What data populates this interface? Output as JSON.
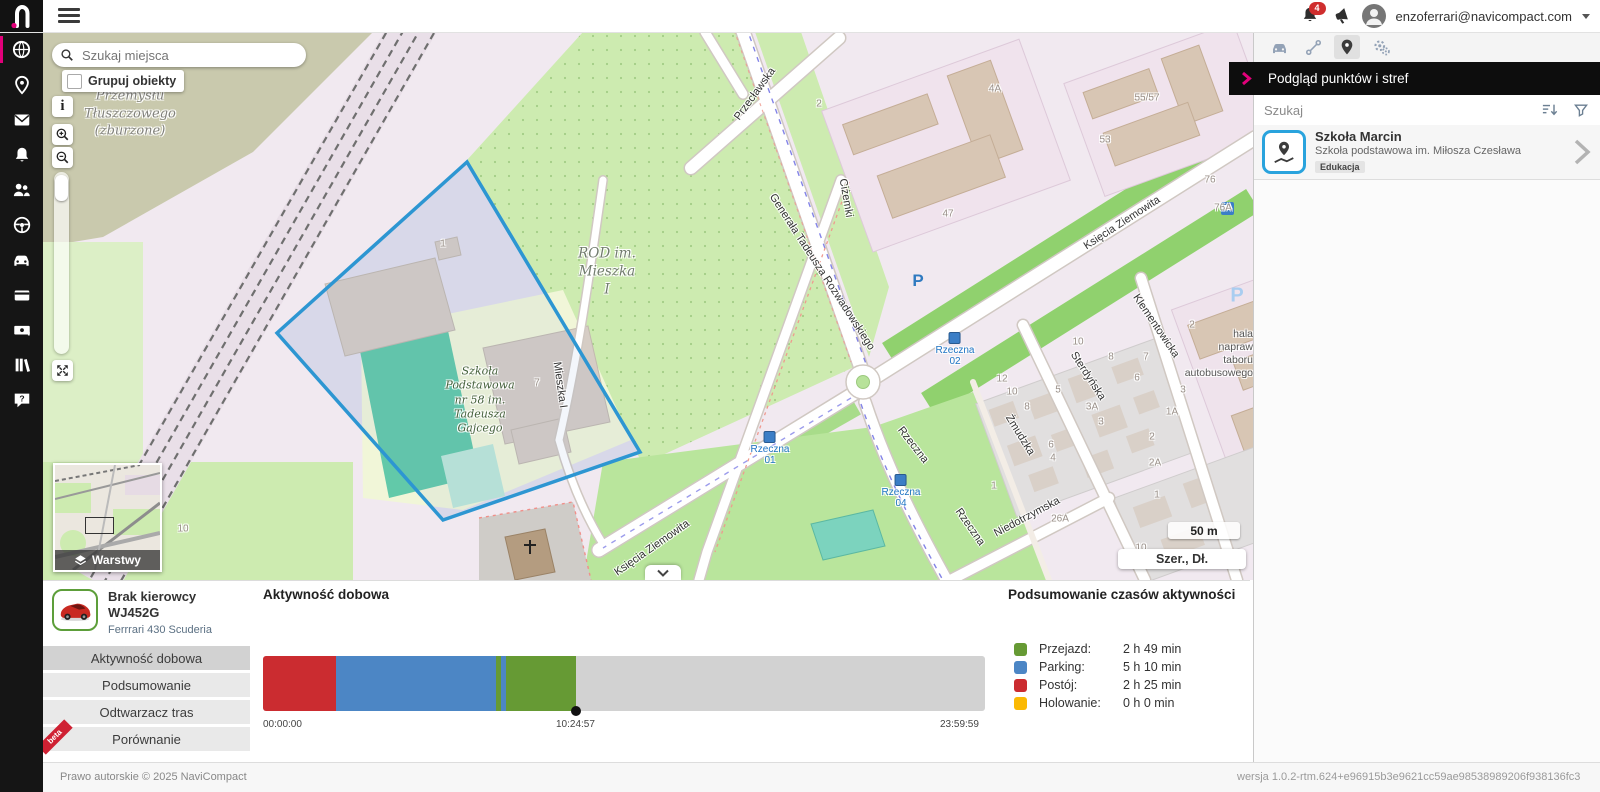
{
  "topbar": {
    "email": "enzoferrari@navicompact.com",
    "notification_count": "4"
  },
  "map": {
    "search_placeholder": "Szukaj miejsca",
    "group_label": "Grupuj obiekty",
    "info_label": "i",
    "layers_label": "Warstwy",
    "scale_label": "50 m",
    "coords_label": "Szer., Dł.",
    "parking_label": "P",
    "labels": {
      "industrial": "Przemysłu\nTłuszczowego\n(zburzone)",
      "rod": "ROD im.\nMieszka\nI",
      "school": "Szkoła\nPodstawowa\nnr 58 im.\nTadeusza\nGajcego",
      "hala": "hala\nnapraw\ntaboru\nautobusowego"
    },
    "streets": {
      "rozwadowskiego": "Generała Tadeusza Rozwadowskiego",
      "przeclawska": "Przecławska",
      "cizemki": "Ciżemki",
      "ksiecia_a": "Księcia Ziemowita",
      "ksiecia_b": "Księcia Ziemowita",
      "mieszka": "Mieszka I",
      "rzeczna_a": "Rzeczna",
      "rzeczna_b": "Rzeczna",
      "zmudzka": "Żmudzka",
      "sterdynska": "Sterdyńska",
      "klementowicka": "Klementowicka",
      "niedotrzymska": "Niedotrzymska"
    },
    "stops": {
      "s01": "Rzeczna\n01",
      "s02": "Rzeczna\n02",
      "s04": "Rzeczna\n04"
    },
    "numbers": [
      {
        "t": "1",
        "x": 400,
        "y": 212
      },
      {
        "t": "2",
        "x": 776,
        "y": 72
      },
      {
        "t": "47",
        "x": 905,
        "y": 182
      },
      {
        "t": "4A",
        "x": 952,
        "y": 57
      },
      {
        "t": "53",
        "x": 1062,
        "y": 108
      },
      {
        "t": "55/57",
        "x": 1104,
        "y": 66
      },
      {
        "t": "76",
        "x": 1167,
        "y": 148
      },
      {
        "t": "76A",
        "x": 1180,
        "y": 176
      },
      {
        "t": "7",
        "x": 494,
        "y": 351
      },
      {
        "t": "12",
        "x": 959,
        "y": 347
      },
      {
        "t": "10",
        "x": 969,
        "y": 360
      },
      {
        "t": "8",
        "x": 984,
        "y": 375
      },
      {
        "t": "5",
        "x": 1015,
        "y": 358
      },
      {
        "t": "3A",
        "x": 1049,
        "y": 375
      },
      {
        "t": "3",
        "x": 1058,
        "y": 390
      },
      {
        "t": "6",
        "x": 1008,
        "y": 413
      },
      {
        "t": "4",
        "x": 1010,
        "y": 426
      },
      {
        "t": "8",
        "x": 1068,
        "y": 325
      },
      {
        "t": "7",
        "x": 1103,
        "y": 325
      },
      {
        "t": "6",
        "x": 1094,
        "y": 346
      },
      {
        "t": "3",
        "x": 1140,
        "y": 358
      },
      {
        "t": "1A",
        "x": 1129,
        "y": 380
      },
      {
        "t": "2",
        "x": 1109,
        "y": 405
      },
      {
        "t": "2A",
        "x": 1112,
        "y": 431
      },
      {
        "t": "1",
        "x": 951,
        "y": 454
      },
      {
        "t": "26A",
        "x": 1017,
        "y": 487
      },
      {
        "t": "10",
        "x": 1098,
        "y": 516
      },
      {
        "t": "1",
        "x": 1114,
        "y": 463
      },
      {
        "t": "10",
        "x": 1035,
        "y": 310
      },
      {
        "t": "2",
        "x": 1149,
        "y": 293
      },
      {
        "t": "10",
        "x": 140,
        "y": 497
      }
    ]
  },
  "right_panel": {
    "title": "Podgląd punktów i stref",
    "search_label": "Szukaj",
    "item": {
      "title": "Szkoła Marcin",
      "subtitle": "Szkoła podstawowa im. Miłosza Czesława",
      "badge": "Edukacja"
    }
  },
  "bottom_panel": {
    "vehicle": {
      "driver": "Brak kierowcy",
      "plate": "WJ452G",
      "model": "Ferrrari 430 Scuderia"
    },
    "tabs": [
      "Aktywność dobowa",
      "Podsumowanie",
      "Odtwarzacz tras",
      "Porównanie"
    ],
    "beta": "beta",
    "activity_title": "Aktywność dobowa",
    "summary_title": "Podsumowanie czasów aktywności",
    "legend": [
      {
        "label": "Przejazd:",
        "value": "2 h 49 min",
        "color": "#669A34"
      },
      {
        "label": "Parking:",
        "value": "5 h 10 min",
        "color": "#4C86C5"
      },
      {
        "label": "Postój:",
        "value": "2 h 25 min",
        "color": "#CB2C30"
      },
      {
        "label": "Holowanie:",
        "value": "0 h 0 min",
        "color": "#FBB903"
      }
    ],
    "timeline": {
      "start_label": "00:00:00",
      "marker_label": "10:24:57",
      "end_label": "23:59:59",
      "total_seconds": 86400,
      "marker_seconds": 37497,
      "segments": [
        {
          "kind": "postoj",
          "color": "#CB2C30",
          "from": 0,
          "to": 8700
        },
        {
          "kind": "parking",
          "color": "#4C86C5",
          "from": 8700,
          "to": 27840
        },
        {
          "kind": "przejazd",
          "color": "#669A34",
          "from": 27840,
          "to": 28440
        },
        {
          "kind": "parking",
          "color": "#4C86C5",
          "from": 28440,
          "to": 29040
        },
        {
          "kind": "przejazd",
          "color": "#669A34",
          "from": 29040,
          "to": 37497
        },
        {
          "kind": "brak-danych",
          "color": "#D2D2D2",
          "from": 37497,
          "to": 86400
        }
      ]
    }
  },
  "footer": {
    "copyright": "Prawo autorskie © 2025  NaviCompact",
    "version": "wersja 1.0.2-rtm.624+e96915b3e9621cc59ae98538989206f938136fc3"
  },
  "colors": {
    "accent_pink": "#E2007A",
    "zone_blue": "#2D96D2",
    "poi_icon_blue": "#29A3DD",
    "badge_red": "#CF2E2E"
  }
}
